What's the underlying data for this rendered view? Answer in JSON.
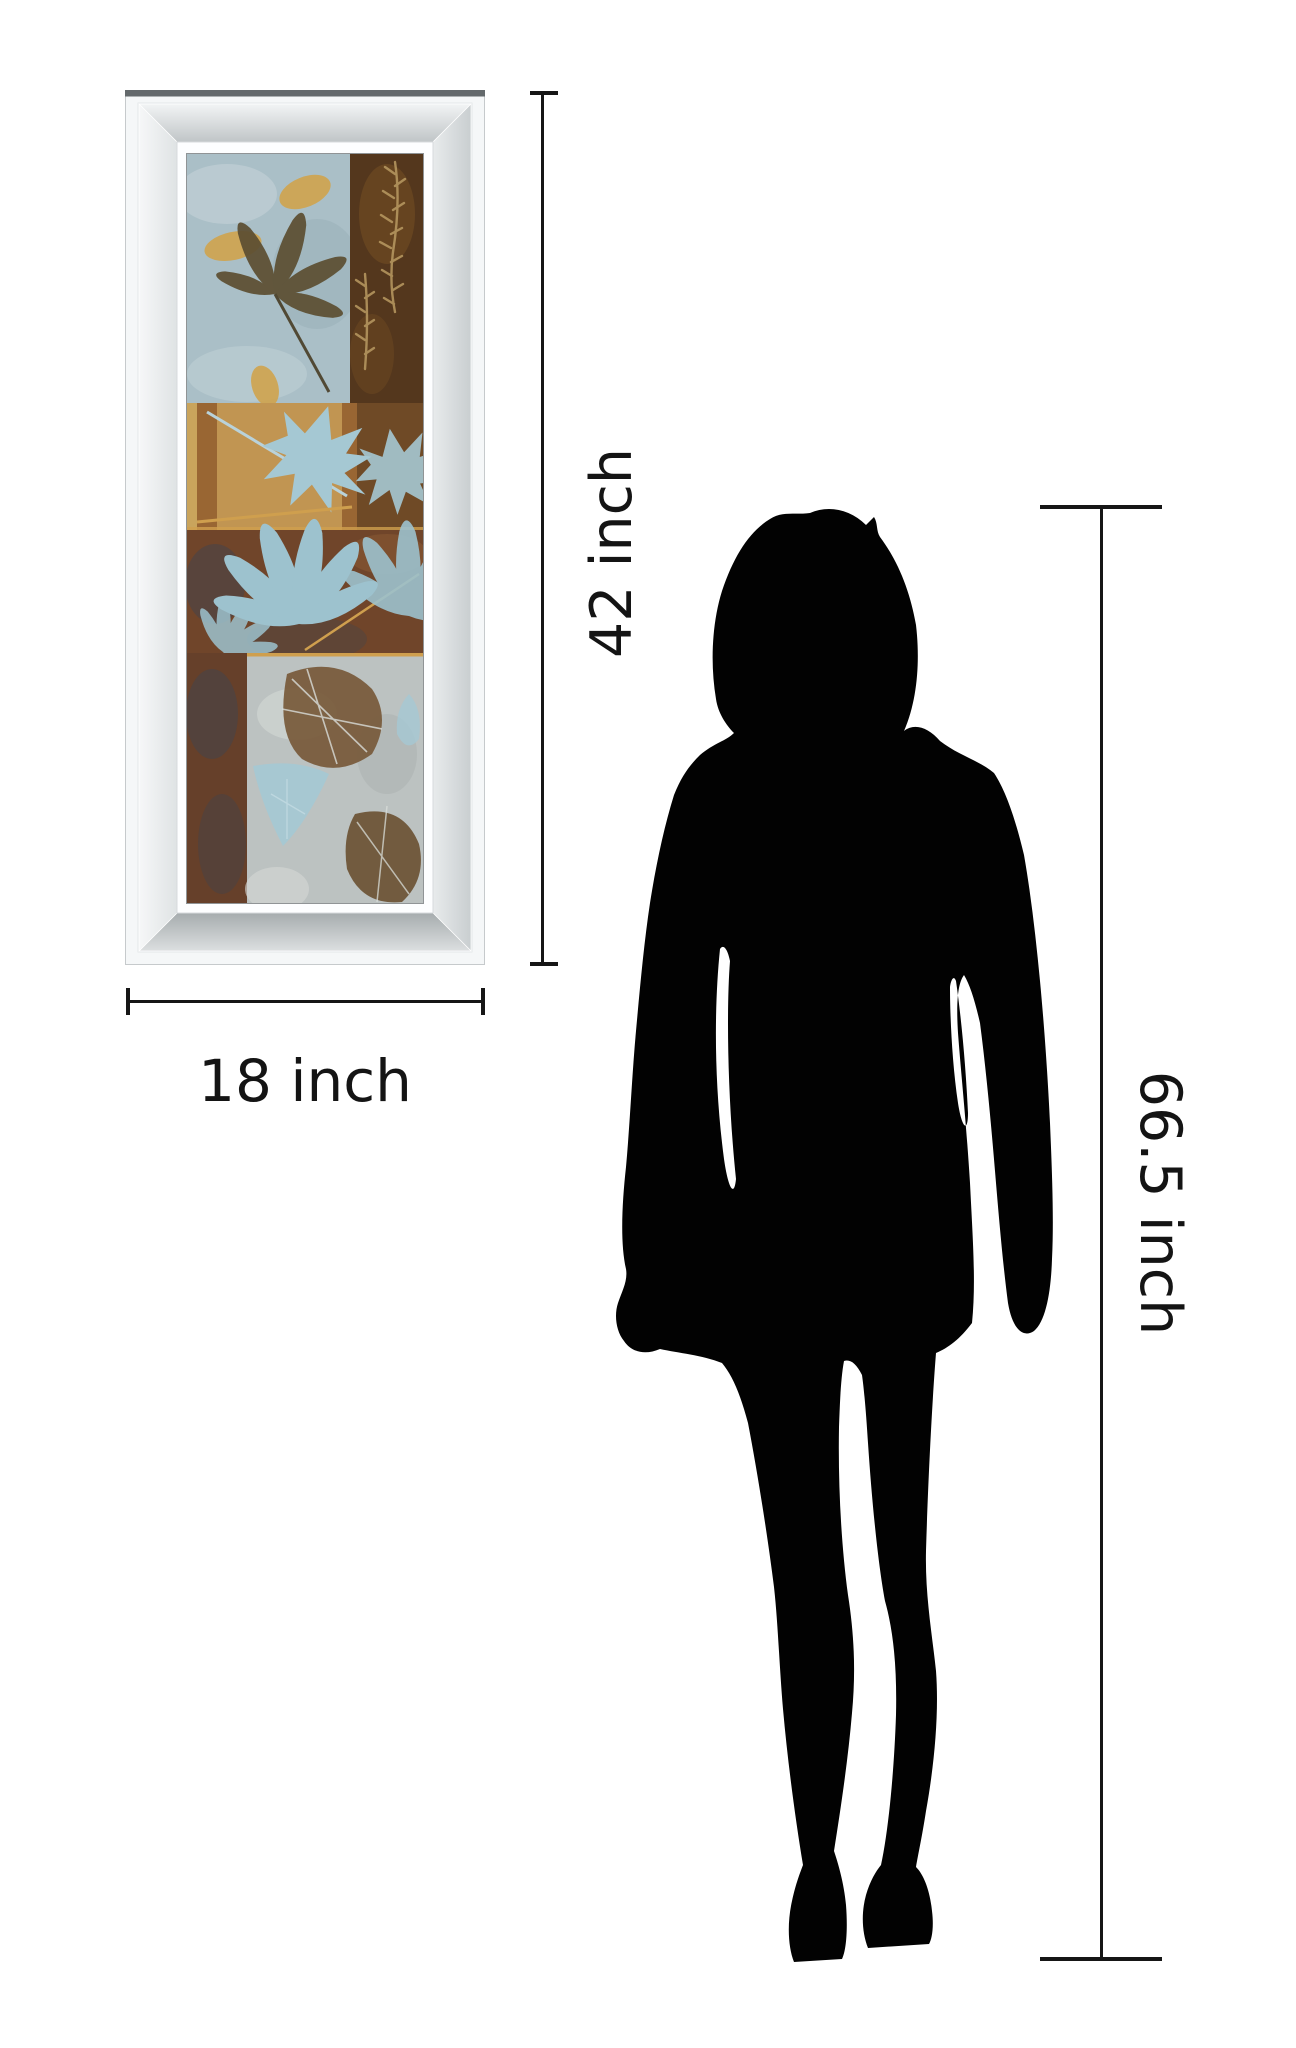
{
  "canvas": {
    "width": 1296,
    "height": 2048,
    "background": "#ffffff"
  },
  "labels": {
    "frame_height": "42 inch",
    "frame_width": "18 inch",
    "person_height": "66.5 inch"
  },
  "colors": {
    "dimension_line": "#161616",
    "label_text": "#141414",
    "silhouette": "#020202",
    "frame_top_edge": "#64696c",
    "frame_face": "#f5f7f8"
  },
  "artwork_palette": {
    "panel_blue": "#aabfc7",
    "panel_blue_light": "#c6d4d9",
    "panel_brown_dark": "#54371d",
    "panel_gold": "#c59a55",
    "panel_gold_strip": "#c9a45c",
    "panel_rust": "#70452a",
    "panel_rust_dark": "#3f444d",
    "panel_silver": "#bcc2c1",
    "leaf_olive": "#5c4e31",
    "leaf_gold": "#d2a246",
    "leaf_blue": "#a5c8d3",
    "leaf_fan_blue": "#9dc2ce",
    "leaf_brown": "#77593a",
    "leaf_vein": "#d9ddda",
    "fern_tan": "#b99a62",
    "gold_accent": "#cf9f4e"
  }
}
